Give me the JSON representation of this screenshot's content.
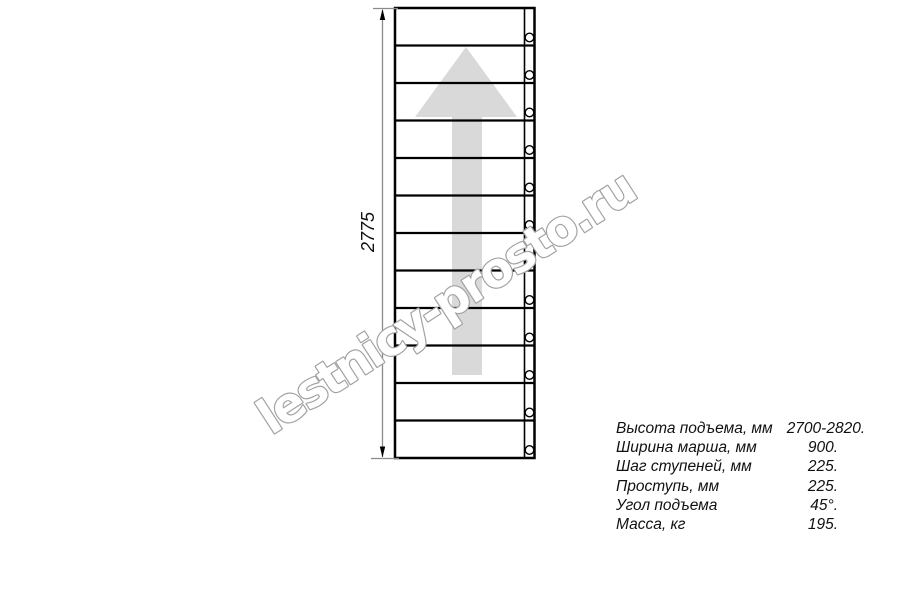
{
  "drawing": {
    "dimension_label": "2775",
    "steps": 12,
    "colors": {
      "line": "#000000",
      "dimension_line": "#8a8a8a",
      "arrow_fill": "#d9d9d9",
      "watermark_stroke": "#a2a2a2"
    }
  },
  "watermark": {
    "text": "lestnicy-prosto.ru"
  },
  "specs": {
    "rows": [
      {
        "label": "Высота подъема, мм",
        "value": "2700-2820."
      },
      {
        "label": "Ширина марша, мм",
        "value": "900."
      },
      {
        "label": "Шаг ступеней, мм",
        "value": "225."
      },
      {
        "label": "Проступь, мм",
        "value": "225."
      },
      {
        "label": "Угол подъема",
        "value": "45°."
      },
      {
        "label": "Масса, кг",
        "value": "195."
      }
    ]
  }
}
